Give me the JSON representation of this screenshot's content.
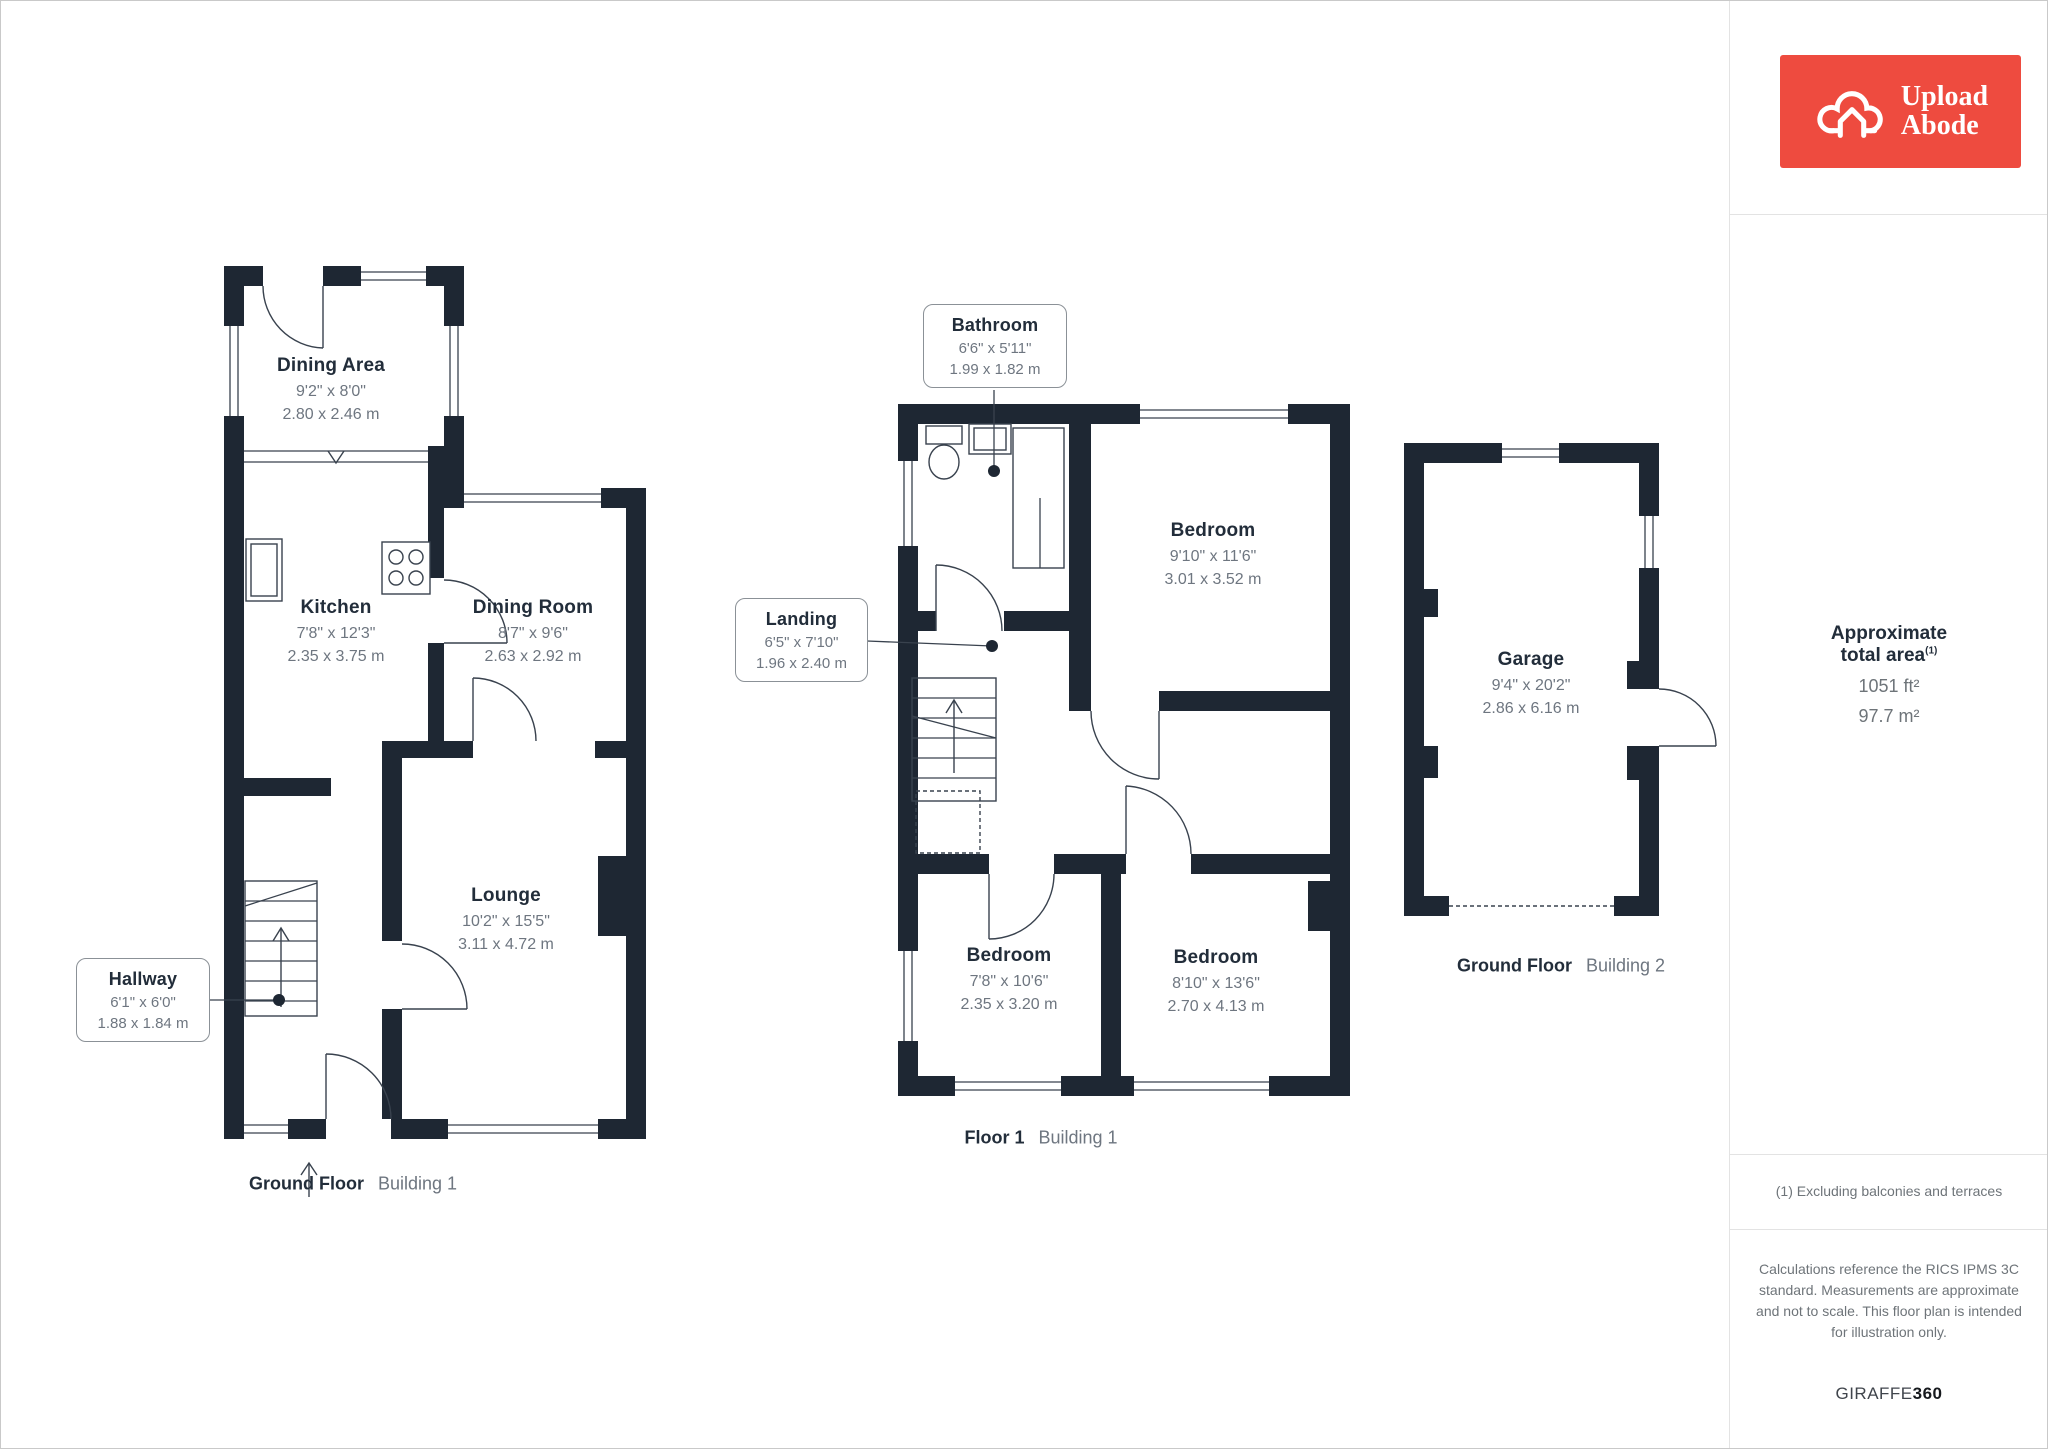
{
  "branding": {
    "logo_line1": "Upload",
    "logo_line2": "Abode",
    "logo_bg": "#ee4b3f",
    "brand_regular": "GIRAFFE",
    "brand_bold": "360"
  },
  "colors": {
    "wall": "#1e2733",
    "room_name_text": "#222d3a",
    "dimension_text": "#6e7680",
    "divider": "#e3e3e3",
    "logo_red": "#ee4b3f"
  },
  "sidebar": {
    "total_area": {
      "title": "Approximate total area",
      "superscript": "(1)",
      "value_imperial": "1051 ft²",
      "value_metric": "97.7 m²"
    },
    "footnote": "(1) Excluding balconies and terraces",
    "disclaimer": "Calculations reference the RICS IPMS 3C standard. Measurements are approximate and not to scale. This floor plan is intended for illustration only."
  },
  "floors": [
    {
      "label_bold": "Ground Floor",
      "label_regular": "Building 1",
      "rooms": [
        {
          "name": "Dining Area",
          "imperial": "9'2\" x 8'0\"",
          "metric": "2.80 x 2.46 m"
        },
        {
          "name": "Kitchen",
          "imperial": "7'8\" x 12'3\"",
          "metric": "2.35 x 3.75 m"
        },
        {
          "name": "Dining Room",
          "imperial": "8'7\" x 9'6\"",
          "metric": "2.63 x 2.92 m"
        },
        {
          "name": "Lounge",
          "imperial": "10'2\" x 15'5\"",
          "metric": "3.11 x 4.72 m"
        }
      ],
      "callouts": [
        {
          "name": "Hallway",
          "imperial": "6'1\" x 6'0\"",
          "metric": "1.88 x 1.84 m"
        }
      ]
    },
    {
      "label_bold": "Floor 1",
      "label_regular": "Building 1",
      "rooms": [
        {
          "name": "Bedroom",
          "imperial": "9'10\" x 11'6\"",
          "metric": "3.01 x 3.52 m"
        },
        {
          "name": "Bedroom",
          "imperial": "7'8\" x 10'6\"",
          "metric": "2.35 x 3.20 m"
        },
        {
          "name": "Bedroom",
          "imperial": "8'10\" x 13'6\"",
          "metric": "2.70 x 4.13 m"
        }
      ],
      "callouts": [
        {
          "name": "Bathroom",
          "imperial": "6'6\" x 5'11\"",
          "metric": "1.99 x 1.82 m"
        },
        {
          "name": "Landing",
          "imperial": "6'5\" x 7'10\"",
          "metric": "1.96 x 2.40 m"
        }
      ]
    },
    {
      "label_bold": "Ground Floor",
      "label_regular": "Building 2",
      "rooms": [
        {
          "name": "Garage",
          "imperial": "9'4\" x 20'2\"",
          "metric": "2.86 x 6.16 m"
        }
      ]
    }
  ]
}
